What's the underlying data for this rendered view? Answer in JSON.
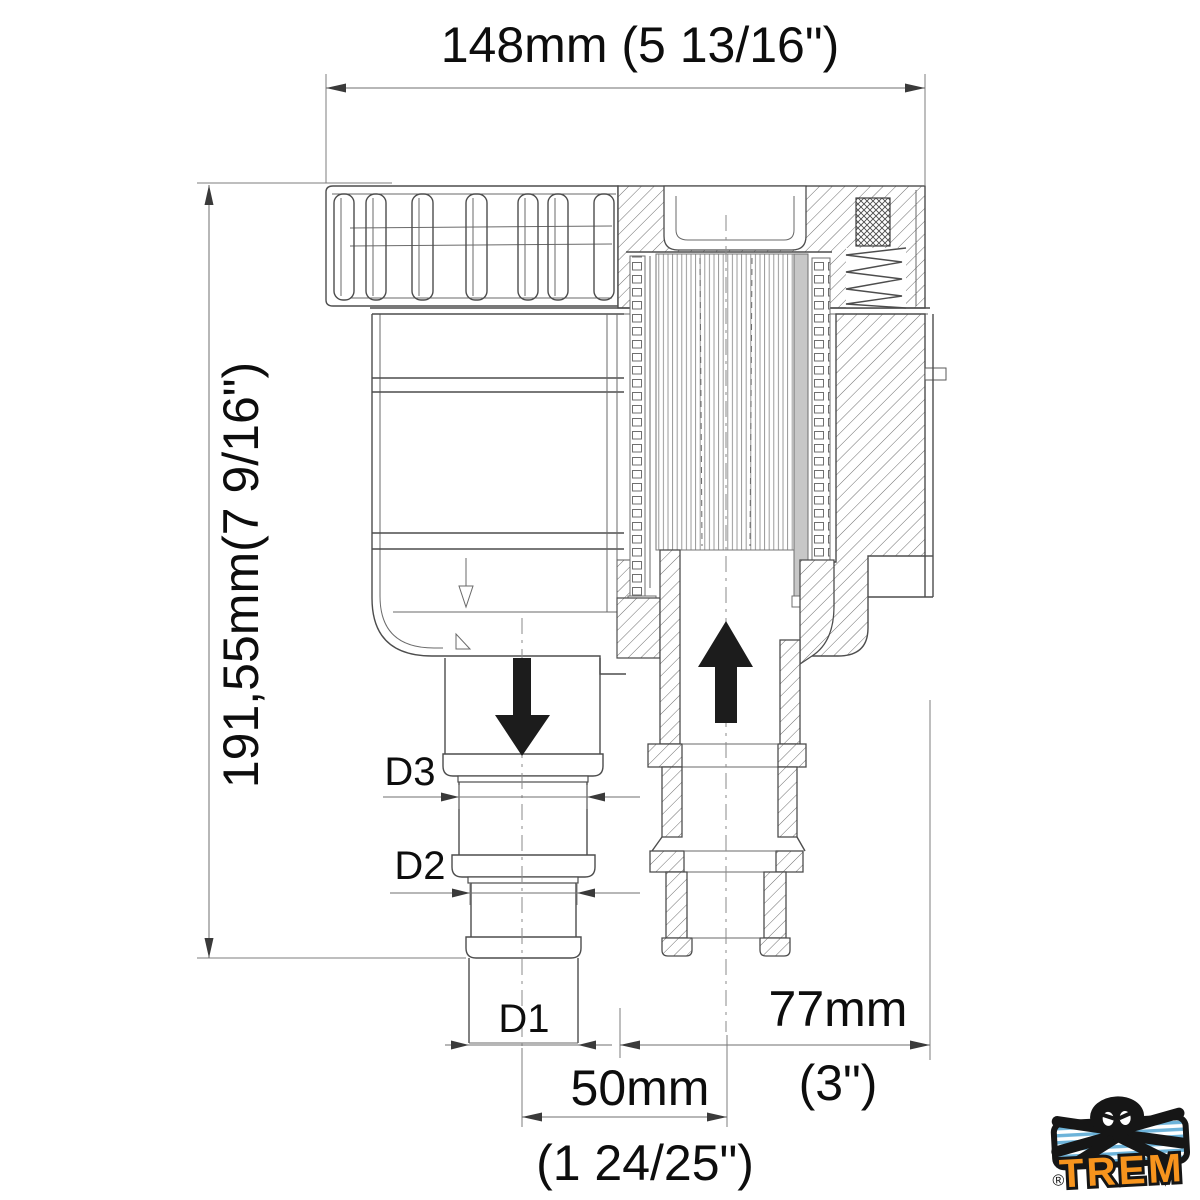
{
  "drawing": {
    "title": "raw-water-strainer-cross-section",
    "dimensions": {
      "overall_width": "148mm (5 13/16\")",
      "overall_height": "191,55mm(7 9/16\")",
      "d3_label": "D3",
      "d2_label": "D2",
      "d1_label": "D1",
      "port_offset_mm": "50mm",
      "port_offset_in": "(1 24/25\")",
      "inlet_offset_mm": "77mm",
      "inlet_offset_in": "(3\")"
    },
    "icons": {
      "outlet_flow": "flow-down-arrow",
      "inlet_flow": "flow-up-arrow"
    },
    "colors": {
      "line": "#4d4d4d",
      "flow_arrow": "#1c1c1c",
      "logo_orange": "#f7941d",
      "logo_blue": "#6db3d9",
      "logo_black": "#161616"
    }
  },
  "logo": {
    "brand": "TREM",
    "registered": "®"
  }
}
